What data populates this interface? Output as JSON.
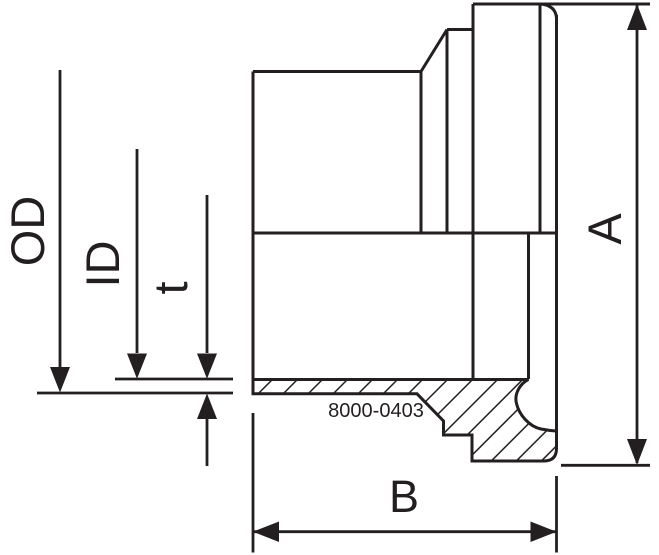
{
  "diagram": {
    "part_number": "8000-0403",
    "dimension_labels": {
      "od": "OD",
      "id": "ID",
      "t": "t",
      "a": "A",
      "b": "B"
    },
    "colors": {
      "line": "#231f20",
      "background": "#ffffff"
    }
  }
}
